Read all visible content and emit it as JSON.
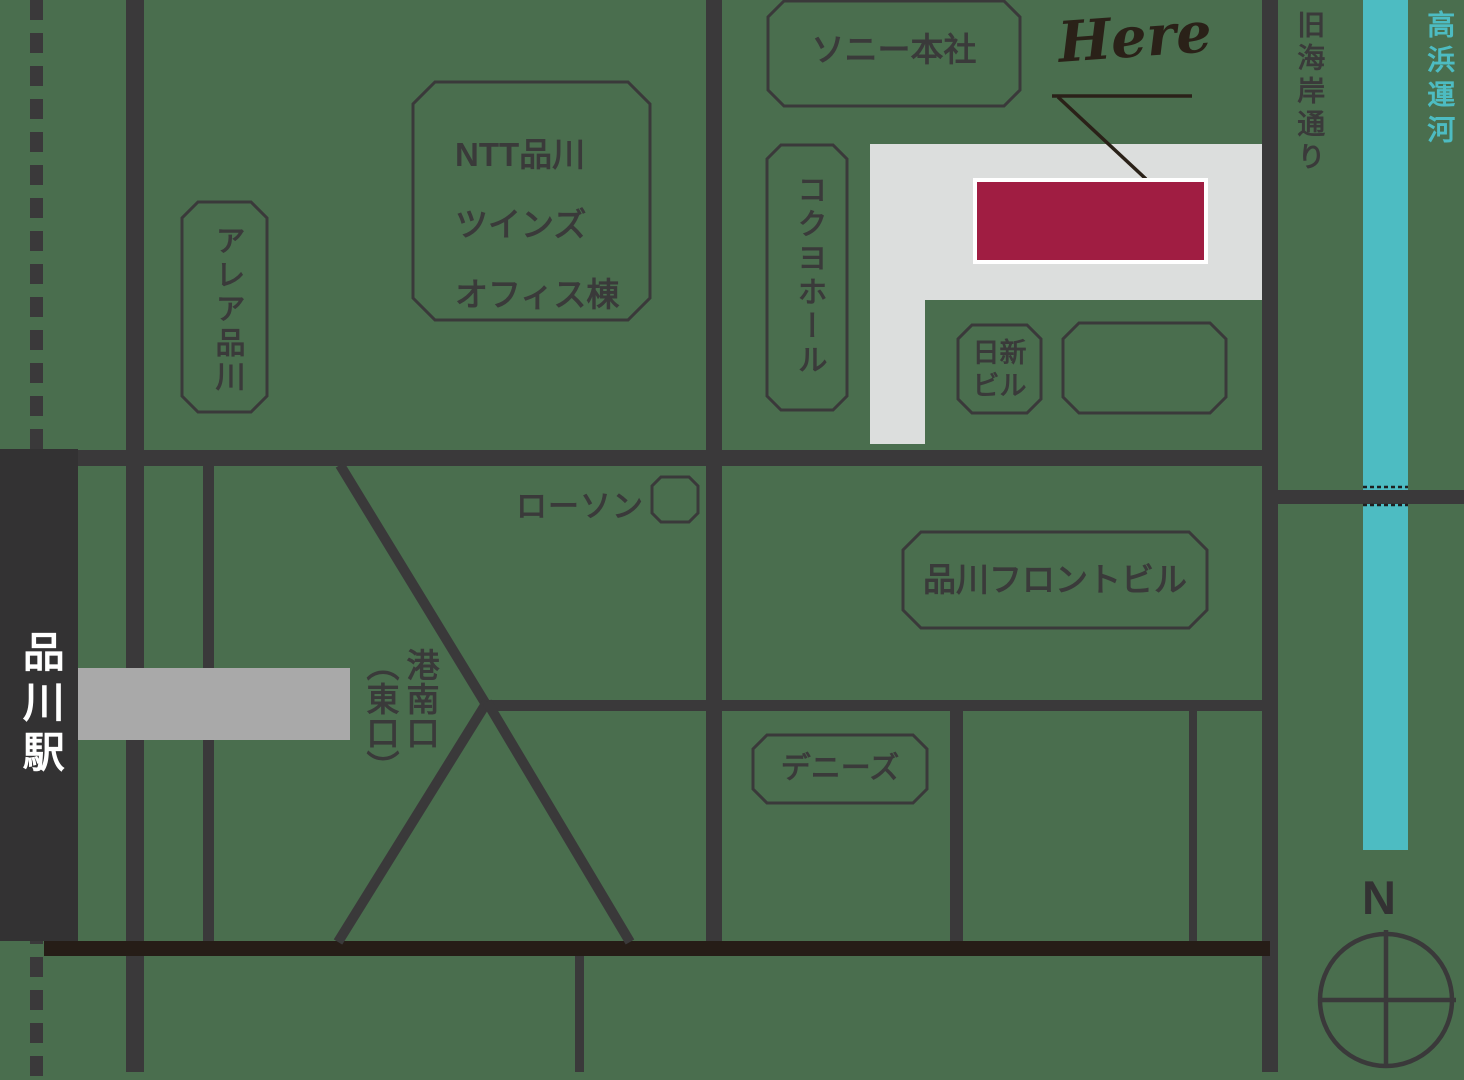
{
  "station": {
    "name": "品川駅"
  },
  "exit": {
    "line1": "港南口",
    "line2": "（東口）"
  },
  "buildings": {
    "area_shinagawa": "アレア品川",
    "ntt_line1": "NTT品川",
    "ntt_line2": "ツインズ",
    "ntt_line3": "オフィス棟",
    "sony": "ソニー本社",
    "kokuyo": "コクヨホール",
    "nisshin_line1": "日新",
    "nisshin_line2": "ビル",
    "front": "品川フロントビル",
    "dennys": "デニーズ",
    "lawson": "ローソン"
  },
  "marker": {
    "label": "Here",
    "color": "#a01d42"
  },
  "street": {
    "old_kaigan": "旧海岸通り"
  },
  "canal": {
    "name": "高浜運河",
    "color": "#4dbcc2"
  },
  "compass": {
    "north": "N"
  },
  "colors": {
    "background": "#4a6e4e",
    "road": "#3a393a",
    "railway_black": "#261d17",
    "station_bar": "#333233",
    "platform_gray": "#a9a9a9",
    "plaza_gray": "#dcdedd",
    "marker_red": "#a01d42",
    "canal_teal": "#4dbcc2",
    "text_dark": "#3a3a3a",
    "text_white": "#ffffff"
  }
}
